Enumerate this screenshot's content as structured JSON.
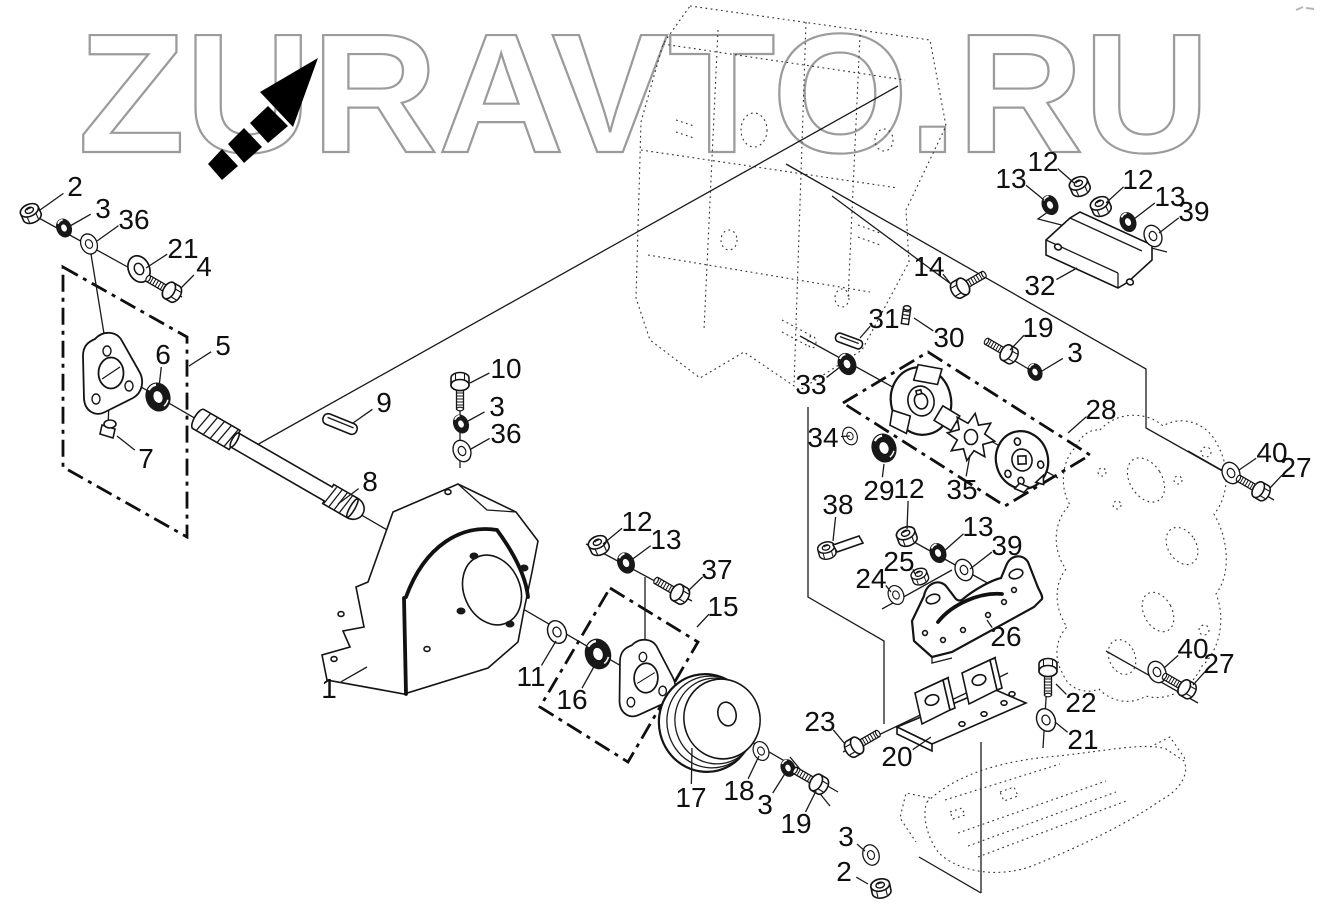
{
  "watermark": {
    "text": "ZURAVTO.RU",
    "outline_color": "#9b9b9b",
    "arrow_color": "#000000"
  },
  "figure": {
    "type": "exploded-parts-diagram",
    "background": "#ffffff",
    "line_color": "#1a1a1a",
    "ghost_line_style": "dotted",
    "callout_font_px": 28,
    "part_numbers_visible": [
      1,
      2,
      3,
      4,
      5,
      6,
      7,
      8,
      9,
      10,
      11,
      12,
      13,
      14,
      15,
      16,
      17,
      18,
      19,
      20,
      21,
      22,
      23,
      24,
      25,
      26,
      27,
      28,
      29,
      30,
      31,
      32,
      33,
      34,
      35,
      36,
      37,
      38,
      39,
      40
    ]
  },
  "callouts": [
    {
      "label": "2",
      "x": 75,
      "y": 186,
      "tx": 40,
      "ty": 210
    },
    {
      "label": "3",
      "x": 103,
      "y": 208,
      "tx": 70,
      "ty": 226
    },
    {
      "label": "36",
      "x": 134,
      "y": 219,
      "tx": 97,
      "ty": 241
    },
    {
      "label": "21",
      "x": 183,
      "y": 248,
      "tx": 146,
      "ty": 268
    },
    {
      "label": "4",
      "x": 204,
      "y": 266,
      "tx": 181,
      "ty": 288
    },
    {
      "label": "5",
      "x": 223,
      "y": 345,
      "tx": 189,
      "ty": 366
    },
    {
      "label": "6",
      "x": 163,
      "y": 354,
      "tx": 159,
      "ty": 387
    },
    {
      "label": "7",
      "x": 146,
      "y": 458,
      "tx": 117,
      "ty": 436
    },
    {
      "label": "9",
      "x": 384,
      "y": 402,
      "tx": 353,
      "ty": 423
    },
    {
      "label": "10",
      "x": 506,
      "y": 368,
      "tx": 470,
      "ty": 383
    },
    {
      "label": "3",
      "x": 497,
      "y": 406,
      "tx": 468,
      "ty": 421
    },
    {
      "label": "36",
      "x": 506,
      "y": 433,
      "tx": 471,
      "ty": 449
    },
    {
      "label": "8",
      "x": 370,
      "y": 481,
      "tx": 338,
      "ty": 504
    },
    {
      "label": "1",
      "x": 329,
      "y": 688,
      "tx": 367,
      "ty": 667
    },
    {
      "label": "11",
      "x": 531,
      "y": 676,
      "tx": 556,
      "ty": 641
    },
    {
      "label": "16",
      "x": 572,
      "y": 699,
      "tx": 596,
      "ty": 663
    },
    {
      "label": "12",
      "x": 637,
      "y": 521,
      "tx": 603,
      "ty": 544
    },
    {
      "label": "13",
      "x": 666,
      "y": 539,
      "tx": 630,
      "ty": 561
    },
    {
      "label": "37",
      "x": 717,
      "y": 569,
      "tx": 688,
      "ty": 591
    },
    {
      "label": "15",
      "x": 723,
      "y": 606,
      "tx": 697,
      "ty": 627
    },
    {
      "label": "17",
      "x": 691,
      "y": 797,
      "tx": 692,
      "ty": 748
    },
    {
      "label": "18",
      "x": 739,
      "y": 790,
      "tx": 759,
      "ty": 756
    },
    {
      "label": "3",
      "x": 765,
      "y": 804,
      "tx": 786,
      "ty": 772
    },
    {
      "label": "19",
      "x": 796,
      "y": 823,
      "tx": 816,
      "ty": 791
    },
    {
      "label": "23",
      "x": 820,
      "y": 721,
      "tx": 845,
      "ty": 744
    },
    {
      "label": "20",
      "x": 897,
      "y": 756,
      "tx": 931,
      "ty": 737
    },
    {
      "label": "22",
      "x": 1081,
      "y": 702,
      "tx": 1056,
      "ty": 684
    },
    {
      "label": "21",
      "x": 1083,
      "y": 739,
      "tx": 1055,
      "ty": 722
    },
    {
      "label": "3",
      "x": 846,
      "y": 836,
      "tx": 865,
      "ty": 851
    },
    {
      "label": "2",
      "x": 844,
      "y": 871,
      "tx": 868,
      "ty": 884
    },
    {
      "label": "13",
      "x": 1011,
      "y": 178,
      "tx": 1044,
      "ty": 200
    },
    {
      "label": "12",
      "x": 1043,
      "y": 161,
      "tx": 1074,
      "ty": 183
    },
    {
      "label": "12",
      "x": 1138,
      "y": 179,
      "tx": 1106,
      "ty": 203
    },
    {
      "label": "13",
      "x": 1170,
      "y": 196,
      "tx": 1134,
      "ty": 219
    },
    {
      "label": "39",
      "x": 1194,
      "y": 211,
      "tx": 1159,
      "ty": 233
    },
    {
      "label": "14",
      "x": 929,
      "y": 266,
      "tx": 950,
      "ty": 283
    },
    {
      "label": "32",
      "x": 1040,
      "y": 285,
      "tx": 1077,
      "ty": 268
    },
    {
      "label": "31",
      "x": 884,
      "y": 318,
      "tx": 860,
      "ty": 338
    },
    {
      "label": "30",
      "x": 949,
      "y": 337,
      "tx": 914,
      "ty": 318
    },
    {
      "label": "33",
      "x": 811,
      "y": 384,
      "tx": 840,
      "ty": 367
    },
    {
      "label": "19",
      "x": 1038,
      "y": 327,
      "tx": 1010,
      "ty": 350
    },
    {
      "label": "3",
      "x": 1075,
      "y": 352,
      "tx": 1042,
      "ty": 371
    },
    {
      "label": "28",
      "x": 1101,
      "y": 409,
      "tx": 1068,
      "ty": 433
    },
    {
      "label": "34",
      "x": 823,
      "y": 437,
      "tx": 850,
      "ty": 436
    },
    {
      "label": "29",
      "x": 879,
      "y": 490,
      "tx": 884,
      "ty": 464
    },
    {
      "label": "35",
      "x": 962,
      "y": 489,
      "tx": 970,
      "ty": 455
    },
    {
      "label": "12",
      "x": 909,
      "y": 488,
      "tx": 907,
      "ty": 529
    },
    {
      "label": "13",
      "x": 978,
      "y": 526,
      "tx": 943,
      "ty": 552
    },
    {
      "label": "39",
      "x": 1007,
      "y": 545,
      "tx": 970,
      "ty": 569
    },
    {
      "label": "38",
      "x": 838,
      "y": 504,
      "tx": 833,
      "ty": 541
    },
    {
      "label": "25",
      "x": 899,
      "y": 561,
      "tx": 915,
      "ty": 574
    },
    {
      "label": "24",
      "x": 871,
      "y": 578,
      "tx": 891,
      "ty": 592
    },
    {
      "label": "26",
      "x": 1006,
      "y": 636,
      "tx": 987,
      "ty": 620
    },
    {
      "label": "40",
      "x": 1272,
      "y": 452,
      "tx": 1239,
      "ty": 470
    },
    {
      "label": "27",
      "x": 1296,
      "y": 467,
      "tx": 1270,
      "ty": 488
    },
    {
      "label": "40",
      "x": 1193,
      "y": 648,
      "tx": 1164,
      "ty": 668
    },
    {
      "label": "27",
      "x": 1219,
      "y": 663,
      "tx": 1193,
      "ty": 685
    }
  ]
}
